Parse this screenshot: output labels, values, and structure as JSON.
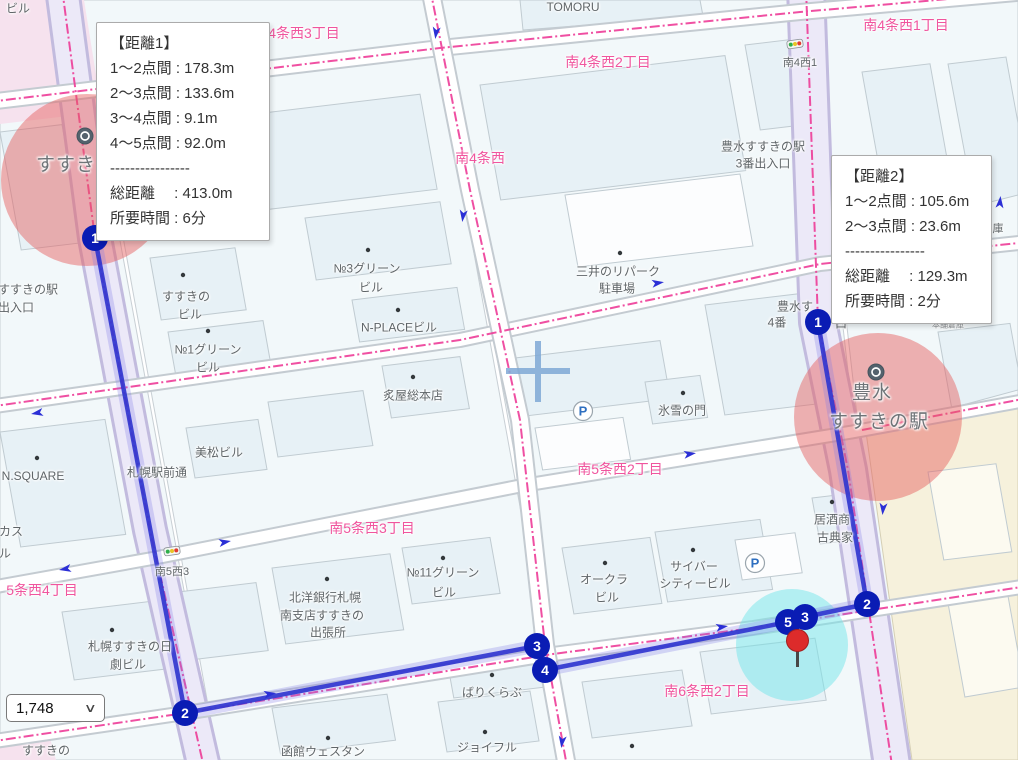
{
  "colors": {
    "route_blue": "#3136CF",
    "route_halo": "rgba(125,118,230,0.28)",
    "marker_navy": "#0A1CB4",
    "district_pink": "#F0559E",
    "boundary_pink": "#EE3D98",
    "station_circle_fill": "rgba(229,93,93,0.47)",
    "destination_circle_fill": "rgba(116,229,234,0.5)",
    "pin_red": "#DD2B2B",
    "road_lavender": "#ECE9F8",
    "block_blue": "#F2F8FA",
    "building_blue": "#E7F1F6"
  },
  "tooltips": {
    "t1": {
      "rows": [
        "【距離1】",
        "1〜2点間 : 178.3m",
        "2〜3点間 : 133.6m",
        "3〜4点間 : 9.1m",
        "4〜5点間 : 92.0m",
        "----------------",
        "総距離　 : 413.0m",
        "所要時間 : 6分"
      ]
    },
    "t2": {
      "rows": [
        "【距離2】",
        "1〜2点間 : 105.6m",
        "2〜3点間 : 23.6m",
        "----------------",
        "総距離　 : 129.3m",
        "所要時間 : 2分"
      ]
    }
  },
  "measurements": {
    "route1": {
      "segments": [
        {
          "from": 1,
          "to": 2,
          "distance_m": 178.3
        },
        {
          "from": 2,
          "to": 3,
          "distance_m": 133.6
        },
        {
          "from": 3,
          "to": 4,
          "distance_m": 9.1
        },
        {
          "from": 4,
          "to": 5,
          "distance_m": 92.0
        }
      ],
      "total_m": 413.0,
      "time_min": 6
    },
    "route2": {
      "segments": [
        {
          "from": 1,
          "to": 2,
          "distance_m": 105.6
        },
        {
          "from": 2,
          "to": 3,
          "distance_m": 23.6
        }
      ],
      "total_m": 129.3,
      "time_min": 2
    }
  },
  "scale_select": {
    "value": "1,748"
  },
  "map": {
    "icons": {
      "parking_glyph": "P",
      "chevron_glyph": "∨"
    },
    "route1_markers": [
      {
        "n": "1",
        "x": 95,
        "y": 238
      },
      {
        "n": "2",
        "x": 185,
        "y": 713
      },
      {
        "n": "3",
        "x": 537,
        "y": 646
      },
      {
        "n": "4",
        "x": 545,
        "y": 670
      },
      {
        "n": "5",
        "x": 788,
        "y": 622
      }
    ],
    "route2_markers": [
      {
        "n": "1",
        "x": 818,
        "y": 322
      },
      {
        "n": "2",
        "x": 867,
        "y": 604
      },
      {
        "n": "3",
        "x": 805,
        "y": 617
      }
    ],
    "destination_pin": {
      "x": 797,
      "y": 641
    },
    "labels": [
      {
        "t": "南4条西3丁目",
        "x": 297,
        "y": 33,
        "c": "district"
      },
      {
        "t": "南4条西2丁目",
        "x": 608,
        "y": 62,
        "c": "district"
      },
      {
        "t": "南4条西1丁目",
        "x": 906,
        "y": 25,
        "c": "district"
      },
      {
        "t": "南4条西",
        "x": 480,
        "y": 158,
        "c": "district"
      },
      {
        "t": "南5条西2丁目",
        "x": 620,
        "y": 469,
        "c": "district"
      },
      {
        "t": "南5条西3丁目",
        "x": 372,
        "y": 528,
        "c": "district"
      },
      {
        "t": "5条西4丁目",
        "x": 42,
        "y": 590,
        "c": "district"
      },
      {
        "t": "南6条西2丁目",
        "x": 707,
        "y": 691,
        "c": "district"
      },
      {
        "t": "すすき",
        "x": 66,
        "y": 163,
        "c": "station"
      },
      {
        "t": "豊水",
        "x": 872,
        "y": 391,
        "c": "station"
      },
      {
        "t": "すすきの駅",
        "x": 879,
        "y": 420,
        "c": "station"
      },
      {
        "t": "ビル",
        "x": 18,
        "y": 8,
        "c": "bldg"
      },
      {
        "t": "TOMORU",
        "x": 573,
        "y": 7,
        "c": "bldg"
      },
      {
        "t": "南4西1",
        "x": 800,
        "y": 62,
        "c": "sm"
      },
      {
        "t": "豊水すすきの駅",
        "x": 763,
        "y": 146,
        "c": "bldg"
      },
      {
        "t": "3番出入口",
        "x": 763,
        "y": 163,
        "c": "bldg"
      },
      {
        "t": "豊水す",
        "x": 795,
        "y": 306,
        "c": "bldg"
      },
      {
        "t": "4番",
        "x": 777,
        "y": 322,
        "c": "bldg"
      },
      {
        "t": "口",
        "x": 841,
        "y": 323,
        "c": "bldg"
      },
      {
        "t": "すすきの駅",
        "x": 28,
        "y": 289,
        "c": "bldg"
      },
      {
        "t": "出入口",
        "x": 16,
        "y": 307,
        "c": "bldg"
      },
      {
        "t": "№3グリーン",
        "x": 367,
        "y": 268,
        "c": "bldg"
      },
      {
        "t": "ビル",
        "x": 371,
        "y": 287,
        "c": "bldg"
      },
      {
        "t": "すすきの",
        "x": 186,
        "y": 296,
        "c": "bldg"
      },
      {
        "t": "ビル",
        "x": 190,
        "y": 314,
        "c": "bldg"
      },
      {
        "t": "N-PLACEビル",
        "x": 399,
        "y": 327,
        "c": "bldg"
      },
      {
        "t": "№1グリーン",
        "x": 208,
        "y": 349,
        "c": "bldg"
      },
      {
        "t": "ビル",
        "x": 208,
        "y": 367,
        "c": "bldg"
      },
      {
        "t": "炙屋総本店",
        "x": 413,
        "y": 395,
        "c": "bldg"
      },
      {
        "t": "三井のリパーク",
        "x": 618,
        "y": 271,
        "c": "bldg"
      },
      {
        "t": "駐車場",
        "x": 617,
        "y": 288,
        "c": "bldg"
      },
      {
        "t": "氷雪の門",
        "x": 682,
        "y": 410,
        "c": "bldg"
      },
      {
        "t": "居酒商",
        "x": 832,
        "y": 519,
        "c": "bldg"
      },
      {
        "t": "古典家",
        "x": 835,
        "y": 537,
        "c": "bldg"
      },
      {
        "t": "オークラ",
        "x": 604,
        "y": 579,
        "c": "bldg"
      },
      {
        "t": "ビル",
        "x": 607,
        "y": 597,
        "c": "bldg"
      },
      {
        "t": "サイバー",
        "x": 694,
        "y": 566,
        "c": "bldg"
      },
      {
        "t": "シティービル",
        "x": 695,
        "y": 583,
        "c": "bldg"
      },
      {
        "t": "№11グリーン",
        "x": 443,
        "y": 572,
        "c": "bldg"
      },
      {
        "t": "ビル",
        "x": 444,
        "y": 592,
        "c": "bldg"
      },
      {
        "t": "北洋銀行札幌",
        "x": 325,
        "y": 597,
        "c": "bldg"
      },
      {
        "t": "南支店すすきの",
        "x": 322,
        "y": 615,
        "c": "bldg"
      },
      {
        "t": "出張所",
        "x": 328,
        "y": 632,
        "c": "bldg"
      },
      {
        "t": "南5西3",
        "x": 172,
        "y": 571,
        "c": "sm"
      },
      {
        "t": "札幌すすきの日",
        "x": 130,
        "y": 646,
        "c": "bldg"
      },
      {
        "t": "劇ビル",
        "x": 128,
        "y": 664,
        "c": "bldg"
      },
      {
        "t": "N.SQUARE",
        "x": 33,
        "y": 476,
        "c": "bldg"
      },
      {
        "t": "札幌駅前通",
        "x": 157,
        "y": 472,
        "c": "bldg"
      },
      {
        "t": "美松ビル",
        "x": 219,
        "y": 452,
        "c": "bldg"
      },
      {
        "t": "カス",
        "x": 11,
        "y": 531,
        "c": "bldg"
      },
      {
        "t": "ル",
        "x": 5,
        "y": 553,
        "c": "bldg"
      },
      {
        "t": "すすきの",
        "x": 46,
        "y": 750,
        "c": "bldg"
      },
      {
        "t": "函館ウェスタン",
        "x": 323,
        "y": 751,
        "c": "bldg"
      },
      {
        "t": "ジョイフル",
        "x": 487,
        "y": 747,
        "c": "bldg"
      },
      {
        "t": "ばりくらぶ",
        "x": 492,
        "y": 692,
        "c": "bldg"
      },
      {
        "t": "庫",
        "x": 998,
        "y": 228,
        "c": "sm"
      },
      {
        "t": "本舗倉庫",
        "x": 948,
        "y": 325,
        "c": "tiny"
      }
    ]
  }
}
